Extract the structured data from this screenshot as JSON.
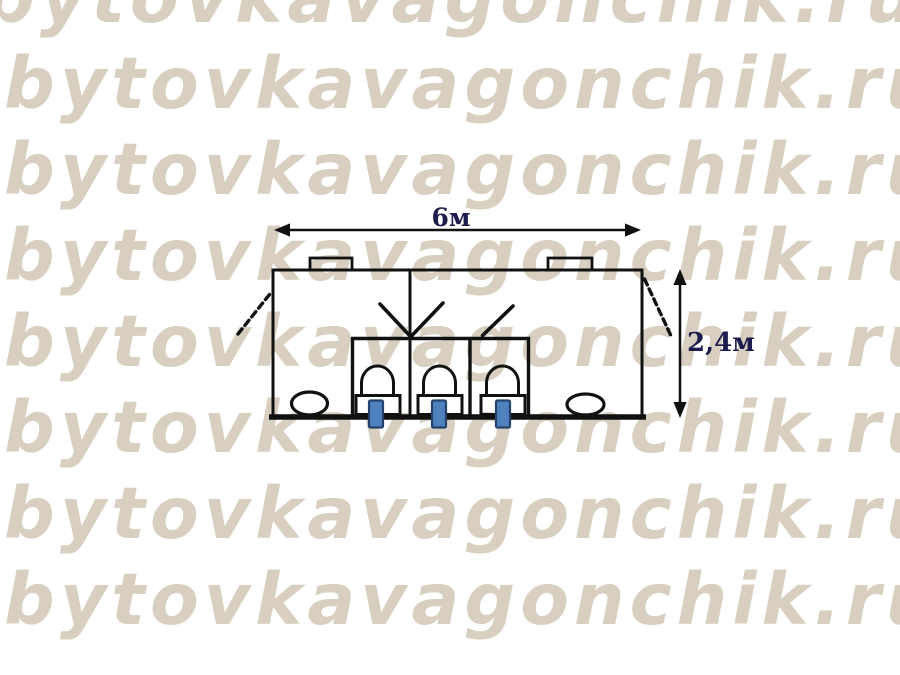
{
  "watermark": {
    "text": "bytovkavagonchik.ru",
    "color": "#d8cfc0",
    "rows": 8
  },
  "diagram": {
    "type": "cabin-floor-plan",
    "dimensions": {
      "width_label": "6м",
      "height_label": "2,4м"
    },
    "colors": {
      "line": "#111111",
      "dimension_label": "#1c1c4e",
      "pipe_fill": "#4f81bd",
      "pipe_border": "#24426b"
    },
    "fixtures": {
      "stalls": 3,
      "toilets": 3,
      "sinks": 2,
      "roof_vents": 2,
      "end_doors": 2
    }
  }
}
